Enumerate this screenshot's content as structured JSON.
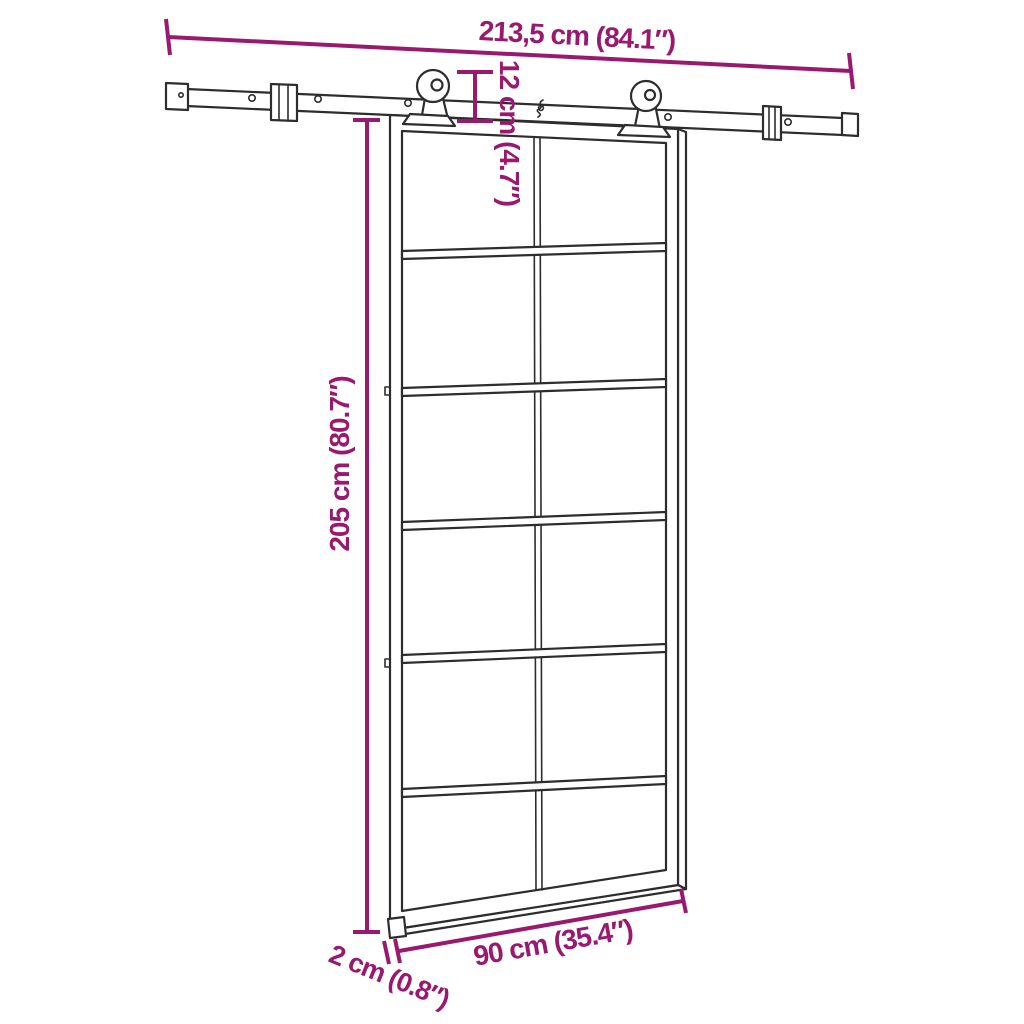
{
  "colors": {
    "dimension": "#99196F",
    "line": "#2D2D2D",
    "background": "#FFFFFF"
  },
  "diagram": {
    "labels": {
      "rail_length": "213,5 cm (84.1″)",
      "hanger_drop": "12 cm (4.7″)",
      "door_height": "205 cm (80.7″)",
      "door_width": "90 cm (35.4″)",
      "door_thickness": "2 cm (0.8″)"
    }
  }
}
